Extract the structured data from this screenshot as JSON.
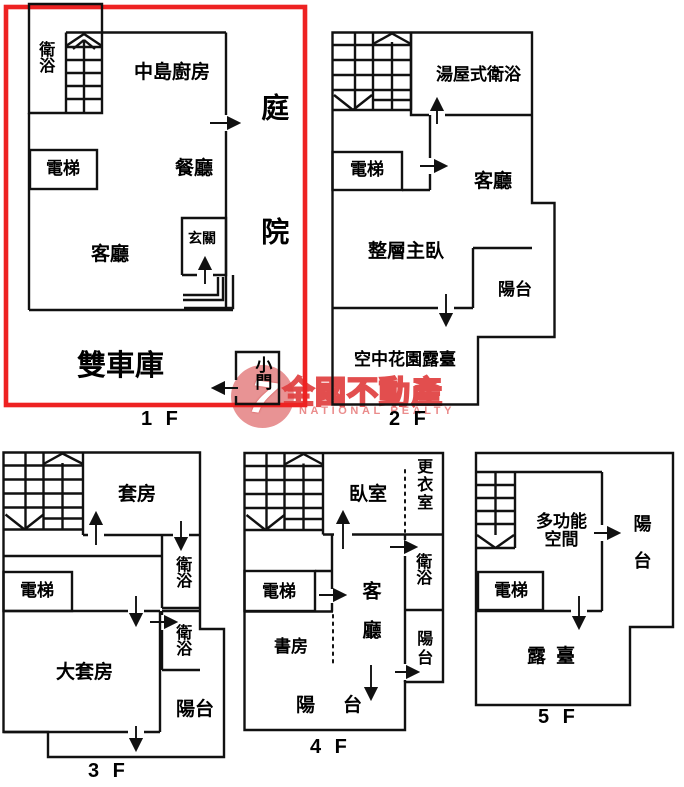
{
  "floors": {
    "f1": {
      "title": "1 F",
      "bath": "衛浴",
      "kitchen": "中島廚房",
      "courtyard": "庭院",
      "elevator": "電梯",
      "dining": "餐廳",
      "living": "客廳",
      "entry": "玄關",
      "garage": "雙車庫",
      "small_door": "小門"
    },
    "f2": {
      "title": "2 F",
      "bath": "湯屋式衛浴",
      "elevator": "電梯",
      "living": "客廳",
      "master": "整層主臥",
      "balcony": "陽台",
      "terrace": "空中花園露臺"
    },
    "f3": {
      "title": "3 F",
      "suite": "套房",
      "bath1": "衛浴",
      "elevator": "電梯",
      "bath2": "衛浴",
      "big_suite": "大套房",
      "balcony": "陽台"
    },
    "f4": {
      "title": "4 F",
      "bedroom": "臥室",
      "closet": "更衣室",
      "bath": "衛浴",
      "elevator": "電梯",
      "living": "客廳",
      "study": "書房",
      "balcony_side": "陽台",
      "balcony_bottom": "陽台"
    },
    "f5": {
      "title": "5 F",
      "multi": "多功能空間",
      "balcony": "陽台",
      "elevator": "電梯",
      "roof_terrace": "露臺"
    }
  },
  "watermark": {
    "brand": "全國不動產",
    "subtitle": "NATIONAL REALTY",
    "logo_glyph": "7"
  },
  "colors": {
    "wall": "#111111",
    "highlight_border": "#ee2222",
    "watermark_red": "#e04040",
    "watermark_pink": "#e87476"
  }
}
